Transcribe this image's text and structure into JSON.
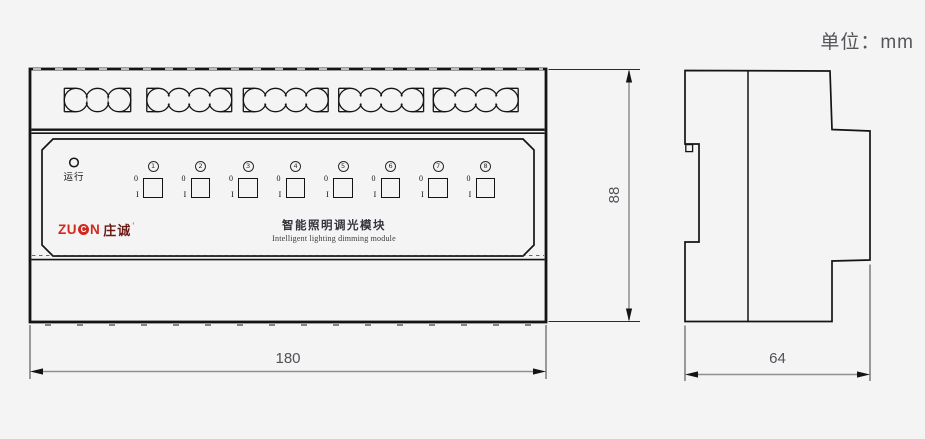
{
  "unit_note": "单位：mm",
  "front_view": {
    "terminal_groups": [
      3,
      4,
      4,
      4,
      4
    ],
    "run_indicator_label": "运行",
    "switch_numbers": [
      "1",
      "2",
      "3",
      "4",
      "5",
      "6",
      "7",
      "8"
    ],
    "switch_off_label": "0",
    "switch_on_label": "I",
    "logo": {
      "zu": "ZU",
      "c": "C",
      "n": "N",
      "cn": "庄诚",
      "mark": "’"
    },
    "product_title_cn": "智能照明调光模块",
    "product_title_en": "Intelligent lighting dimming module"
  },
  "dimensions": {
    "width_mm": "180",
    "height_mm": "88",
    "depth_mm": "64"
  },
  "colors": {
    "line": "#141414",
    "background": "#f4f4f5",
    "dimension_line": "#8f8f8f",
    "dimension_text": "#515156",
    "logo_red": "#d3281e",
    "logo_dark_red": "#6b1a14",
    "title_text": "#33343c"
  }
}
